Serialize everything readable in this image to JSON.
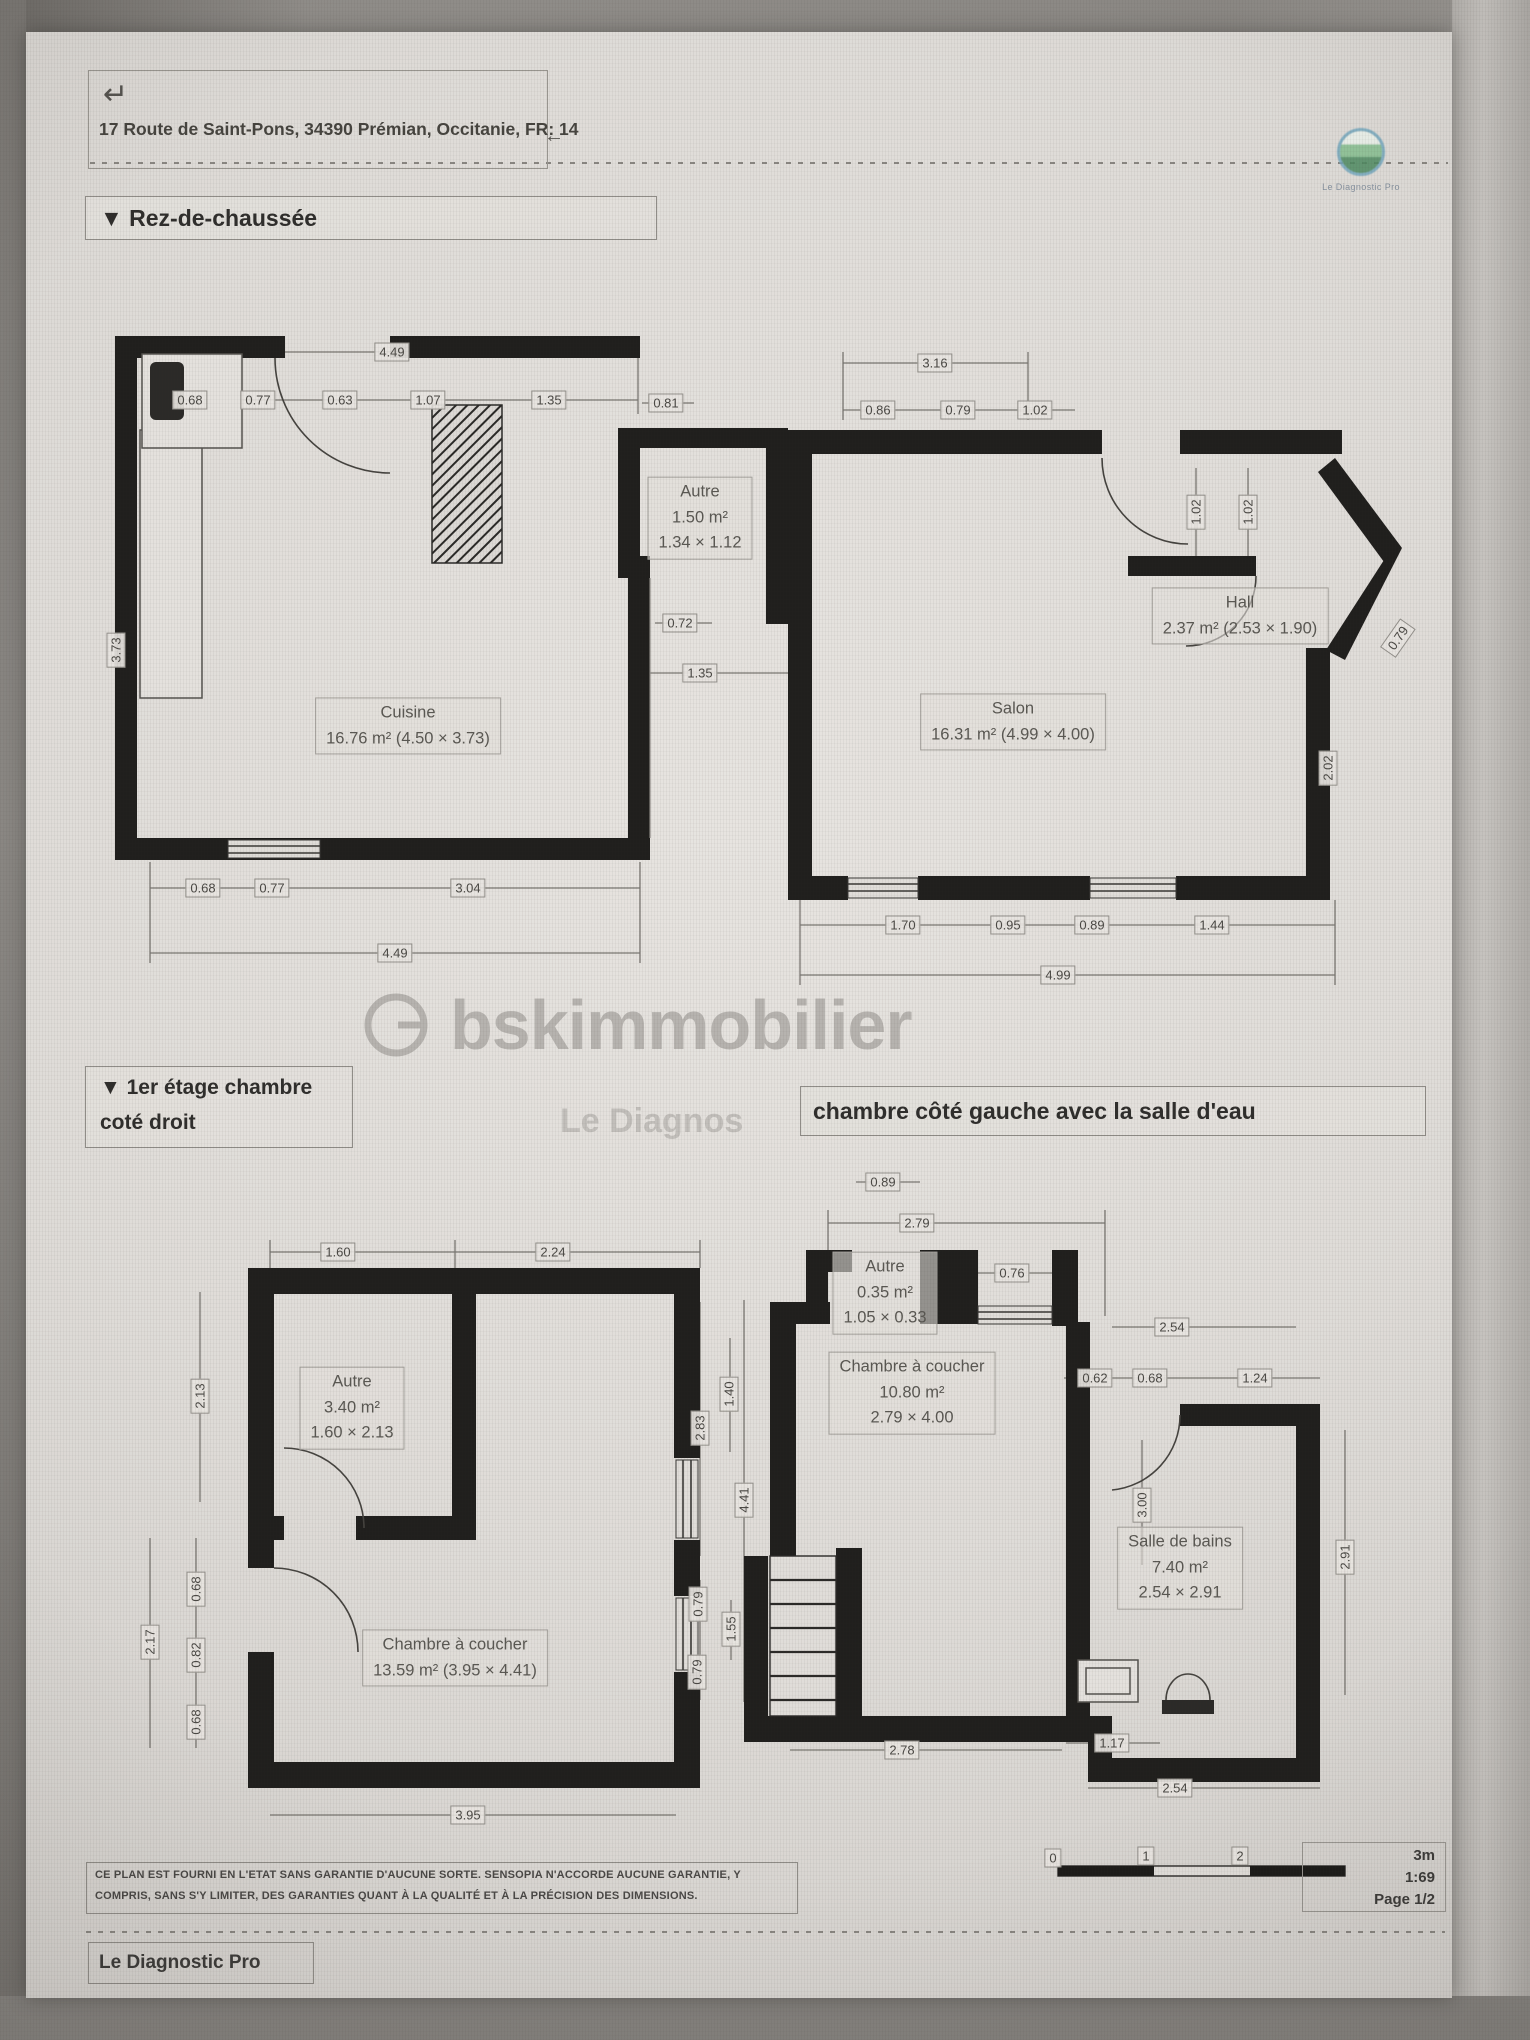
{
  "header": {
    "return_icon": "↵",
    "address": "17 Route de Saint-Pons, 34390 Prémian, Occitanie, FR: 14",
    "back_icon": "←"
  },
  "logo": {
    "caption": "Le Diagnostic Pro"
  },
  "watermark": {
    "brand": "bskimmobilier",
    "fragment": "Le Diagnos"
  },
  "sections": {
    "ground_title": "▼  Rez-de-chaussée",
    "floor1_right_title": "▼  1er étage chambre\ncoté droit",
    "floor1_left_title": "chambre côté gauche avec la salle d'eau"
  },
  "ground_floor": {
    "labels": [
      {
        "t": "4.49",
        "x": 392,
        "y": 352
      },
      {
        "t": "0.68",
        "x": 190,
        "y": 400
      },
      {
        "t": "0.77",
        "x": 258,
        "y": 400
      },
      {
        "t": "0.63",
        "x": 340,
        "y": 400
      },
      {
        "t": "1.07",
        "x": 428,
        "y": 400
      },
      {
        "t": "1.35",
        "x": 549,
        "y": 400
      },
      {
        "t": "0.81",
        "x": 666,
        "y": 403
      },
      {
        "t": "3.16",
        "x": 935,
        "y": 363
      },
      {
        "t": "0.86",
        "x": 878,
        "y": 410
      },
      {
        "t": "0.79",
        "x": 958,
        "y": 410
      },
      {
        "t": "1.02",
        "x": 1035,
        "y": 410
      },
      {
        "t": "Autre\n1.50 m²\n1.34 × 1.12",
        "x": 700,
        "y": 518,
        "k": "room"
      },
      {
        "t": "0.72",
        "x": 680,
        "y": 623
      },
      {
        "t": "1.35",
        "x": 700,
        "y": 673
      },
      {
        "t": "1.02",
        "x": 1196,
        "y": 512,
        "r": -90
      },
      {
        "t": "1.02",
        "x": 1248,
        "y": 512,
        "r": -90
      },
      {
        "t": "Hall\n2.37 m² (2.53 × 1.90)",
        "x": 1240,
        "y": 616,
        "k": "room"
      },
      {
        "t": "0.79",
        "x": 1398,
        "y": 638,
        "r": -55
      },
      {
        "t": "2.02",
        "x": 1328,
        "y": 768,
        "r": -90
      },
      {
        "t": "3.73",
        "x": 116,
        "y": 650,
        "r": -90
      },
      {
        "t": "Cuisine\n16.76 m² (4.50 × 3.73)",
        "x": 408,
        "y": 726,
        "k": "room"
      },
      {
        "t": "Salon\n16.31 m² (4.99 × 4.00)",
        "x": 1013,
        "y": 722,
        "k": "room"
      },
      {
        "t": "0.68",
        "x": 203,
        "y": 888
      },
      {
        "t": "0.77",
        "x": 272,
        "y": 888
      },
      {
        "t": "3.04",
        "x": 468,
        "y": 888
      },
      {
        "t": "4.49",
        "x": 395,
        "y": 953
      },
      {
        "t": "1.70",
        "x": 903,
        "y": 925
      },
      {
        "t": "0.95",
        "x": 1008,
        "y": 925
      },
      {
        "t": "0.89",
        "x": 1092,
        "y": 925
      },
      {
        "t": "1.44",
        "x": 1212,
        "y": 925
      },
      {
        "t": "4.99",
        "x": 1058,
        "y": 975
      }
    ]
  },
  "first_floor": {
    "labels": [
      {
        "t": "1.60",
        "x": 338,
        "y": 1252
      },
      {
        "t": "2.24",
        "x": 553,
        "y": 1252
      },
      {
        "t": "2.13",
        "x": 200,
        "y": 1396,
        "r": -90
      },
      {
        "t": "Autre\n3.40 m²\n1.60 × 2.13",
        "x": 352,
        "y": 1408,
        "k": "room"
      },
      {
        "t": "2.17",
        "x": 150,
        "y": 1642,
        "r": -90
      },
      {
        "t": "0.68",
        "x": 196,
        "y": 1589,
        "r": -90
      },
      {
        "t": "0.82",
        "x": 196,
        "y": 1655,
        "r": -90
      },
      {
        "t": "0.68",
        "x": 196,
        "y": 1722,
        "r": -90
      },
      {
        "t": "Chambre à coucher\n13.59 m² (3.95 × 4.41)",
        "x": 455,
        "y": 1658,
        "k": "room"
      },
      {
        "t": "3.95",
        "x": 468,
        "y": 1815
      },
      {
        "t": "1.40",
        "x": 729,
        "y": 1394,
        "r": -90
      },
      {
        "t": "2.83",
        "x": 700,
        "y": 1428,
        "r": -90
      },
      {
        "t": "4.41",
        "x": 744,
        "y": 1500,
        "r": -90
      },
      {
        "t": "0.79",
        "x": 698,
        "y": 1604,
        "r": -90
      },
      {
        "t": "1.55",
        "x": 731,
        "y": 1629,
        "r": -90
      },
      {
        "t": "0.79",
        "x": 697,
        "y": 1672,
        "r": -90
      },
      {
        "t": "0.89",
        "x": 883,
        "y": 1182
      },
      {
        "t": "2.79",
        "x": 917,
        "y": 1223
      },
      {
        "t": "Autre\n0.35 m²\n1.05 × 0.33",
        "x": 885,
        "y": 1293,
        "k": "room"
      },
      {
        "t": "0.76",
        "x": 1012,
        "y": 1273
      },
      {
        "t": "Chambre à coucher\n10.80 m²\n2.79 × 4.00",
        "x": 912,
        "y": 1393,
        "k": "room"
      },
      {
        "t": "2.54",
        "x": 1172,
        "y": 1327
      },
      {
        "t": "0.62",
        "x": 1095,
        "y": 1378
      },
      {
        "t": "0.68",
        "x": 1150,
        "y": 1378
      },
      {
        "t": "1.24",
        "x": 1255,
        "y": 1378
      },
      {
        "t": "3.00",
        "x": 1142,
        "y": 1505,
        "r": -90
      },
      {
        "t": "Salle de bains\n7.40 m²\n2.54 × 2.91",
        "x": 1180,
        "y": 1568,
        "k": "room"
      },
      {
        "t": "2.91",
        "x": 1345,
        "y": 1557,
        "r": -90
      },
      {
        "t": "2.78",
        "x": 902,
        "y": 1750
      },
      {
        "t": "1.17",
        "x": 1112,
        "y": 1743
      },
      {
        "t": "2.54",
        "x": 1175,
        "y": 1788
      }
    ]
  },
  "footer": {
    "disclaimer": "CE PLAN EST FOURNI EN L'ETAT SANS GARANTIE D'AUCUNE SORTE. SENSOPIA N'ACCORDE AUCUNE GARANTIE, Y\nCOMPRIS, SANS S'Y LIMITER, DES GARANTIES QUANT À LA QUALITÉ ET À LA PRÉCISION DES DIMENSIONS.",
    "brand_box": "Le Diagnostic Pro",
    "scale": {
      "ticks": [
        {
          "t": "0",
          "x": 1053,
          "y": 1858
        },
        {
          "t": "1",
          "x": 1146,
          "y": 1856
        },
        {
          "t": "2",
          "x": 1240,
          "y": 1856
        }
      ],
      "unit": "3m",
      "ratio": "1:69",
      "page": "Page 1/2"
    }
  }
}
